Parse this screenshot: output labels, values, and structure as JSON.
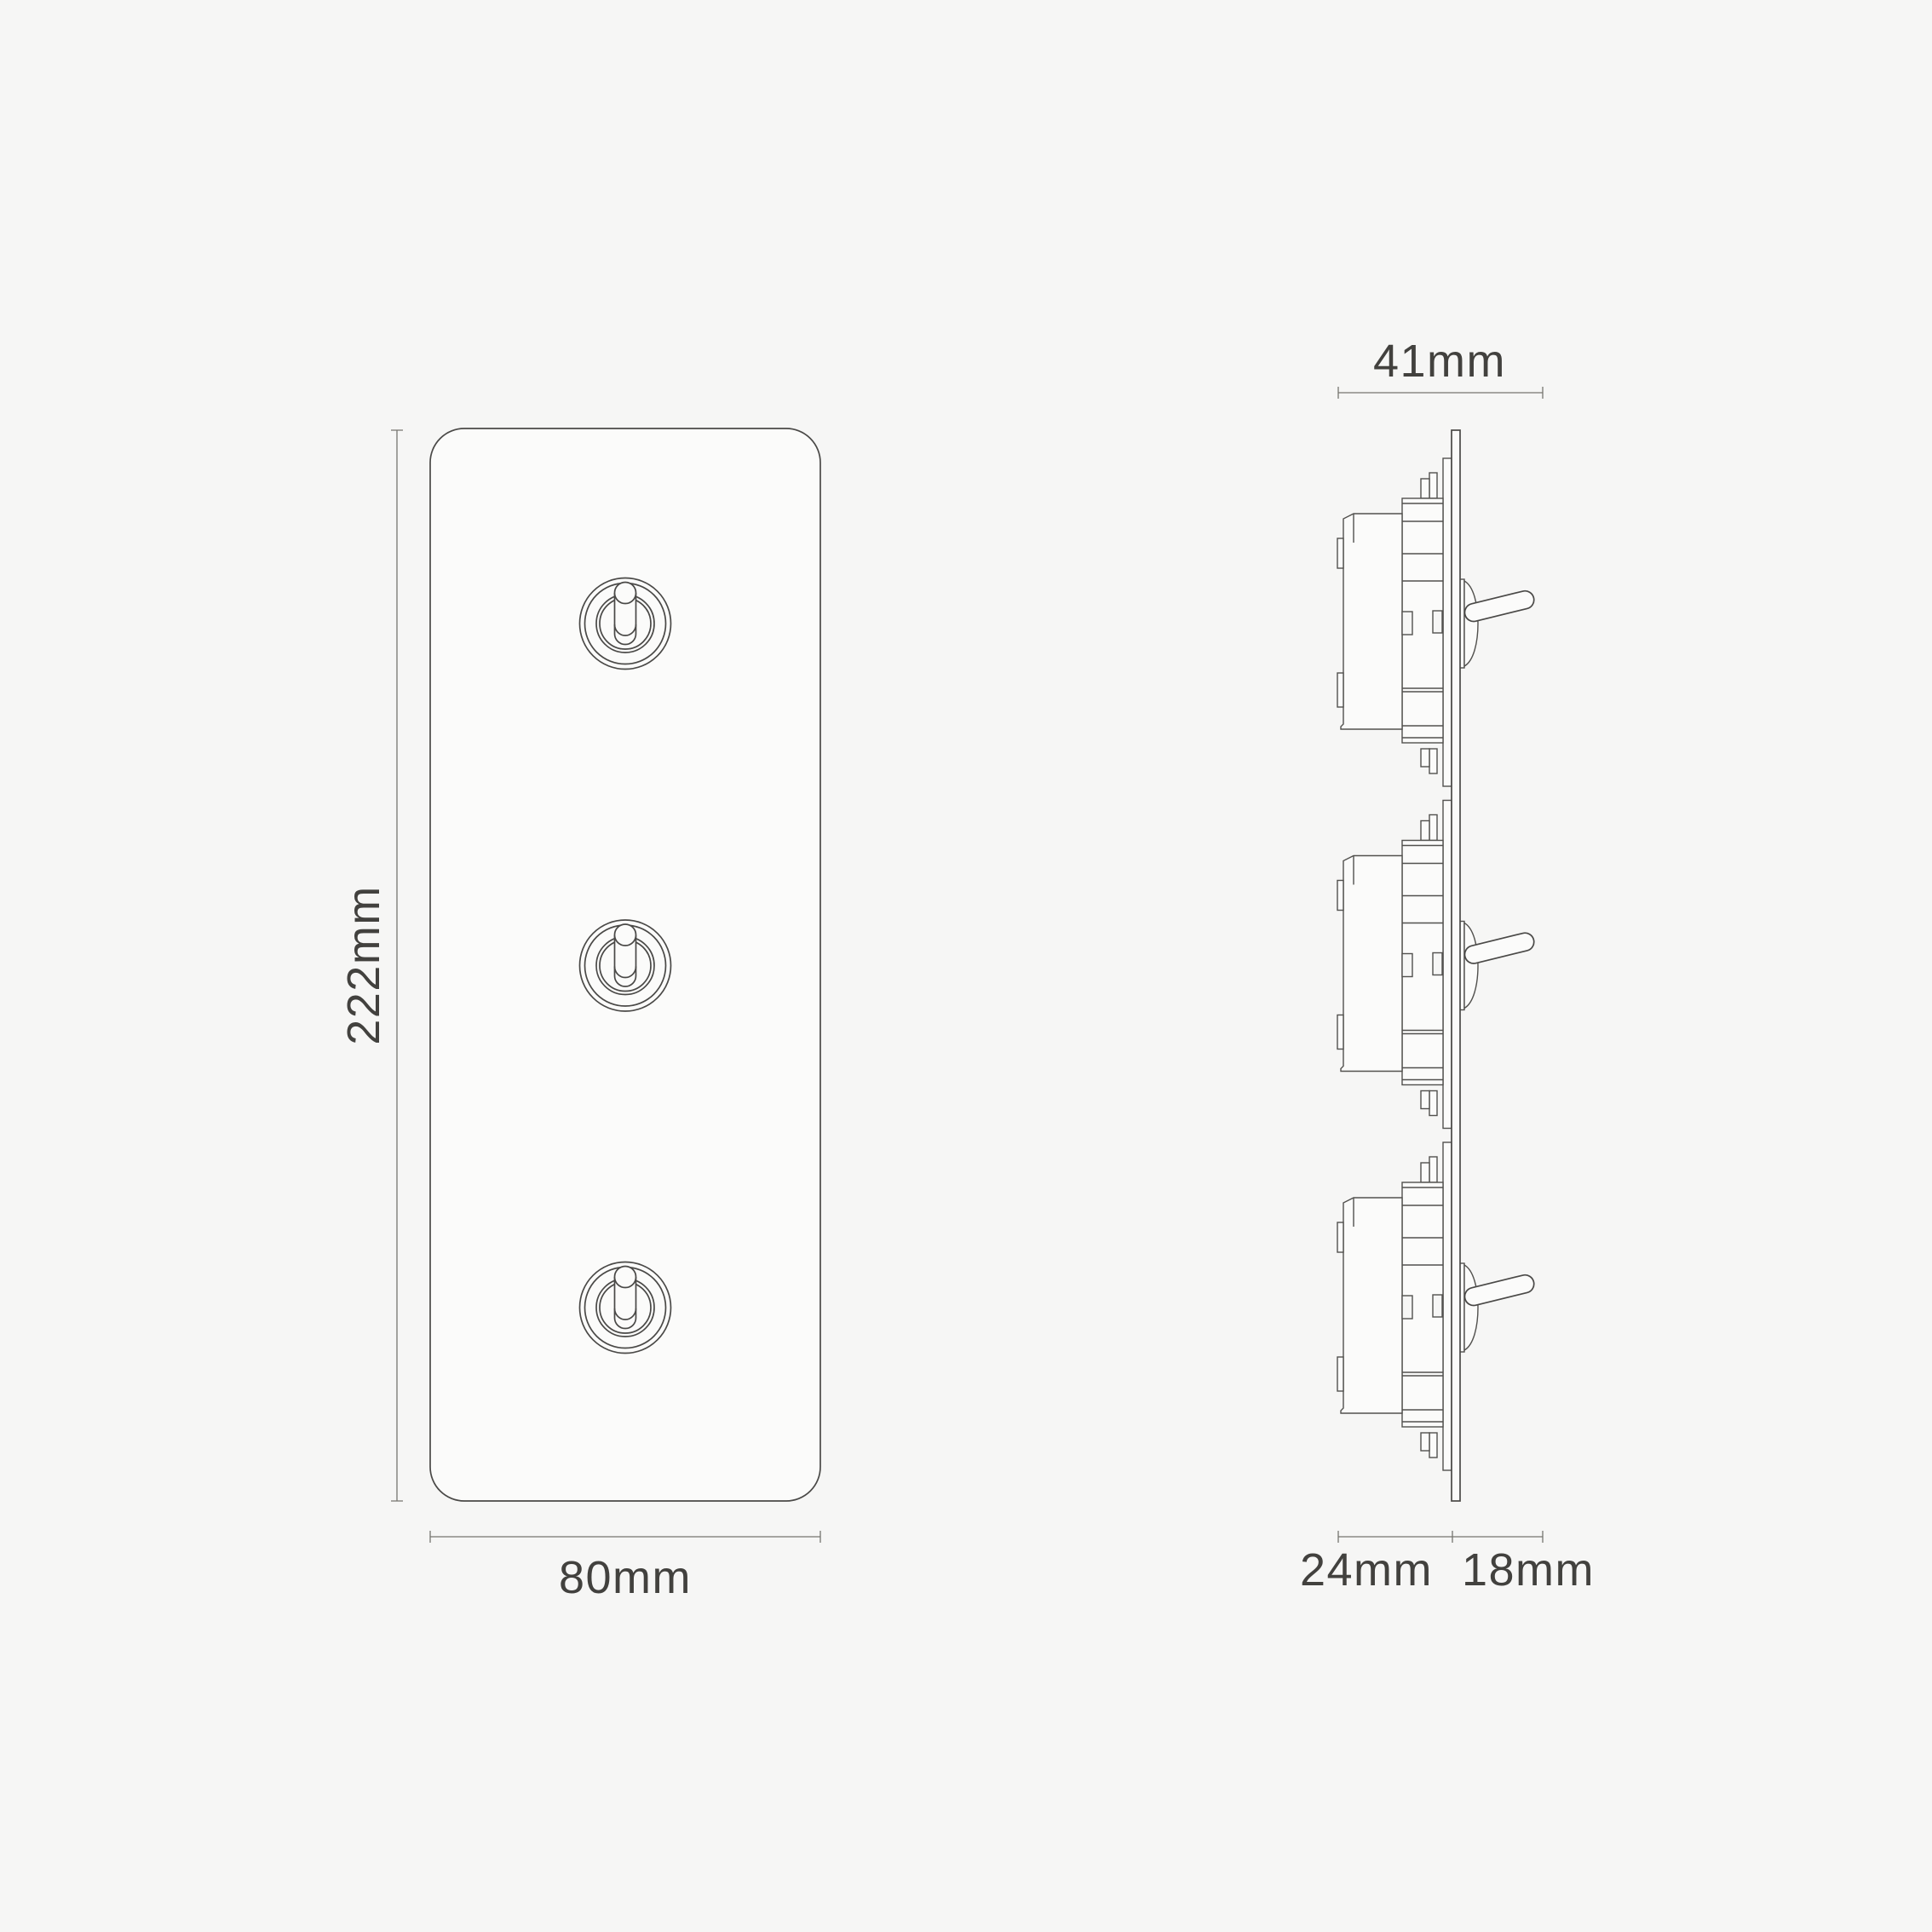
{
  "drawing": {
    "kind": "technical-dimension-diagram",
    "colors": {
      "background": "#f6f6f5",
      "line": "#4a4947",
      "dimension_line": "#76756f",
      "label_text": "#42413e",
      "shape_fill": "#fbfbfa"
    },
    "front_view": {
      "toggle_count": 3,
      "height_label": "222mm",
      "width_label": "80mm"
    },
    "side_view": {
      "module_count": 3,
      "total_depth_label": "41mm",
      "mechanism_depth_label": "24mm",
      "toggle_projection_label": "18mm"
    }
  }
}
